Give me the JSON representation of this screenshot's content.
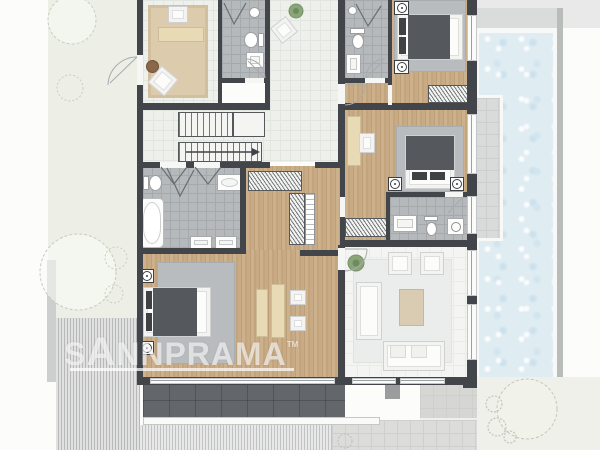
{
  "watermark": {
    "full_text": "SANNPRAMA",
    "prefix": "S",
    "logo_letter": "A",
    "suffix": "NNPRAMA",
    "tm": "TM"
  },
  "colors": {
    "wall": "#42464b",
    "wood_floor": "#c7a981",
    "light_tile": "#eef0ec",
    "bath_tile": "#b5b9bc",
    "pool_water": "#dfecf2",
    "garden": "#edefe7",
    "deck_stripes": "#c4c6c5",
    "terrace": "#63666a",
    "rug_gray": "#b9bcbe",
    "rug_beige": "#dccbac",
    "watermark_text": "rgba(255,255,255,0.62)"
  }
}
